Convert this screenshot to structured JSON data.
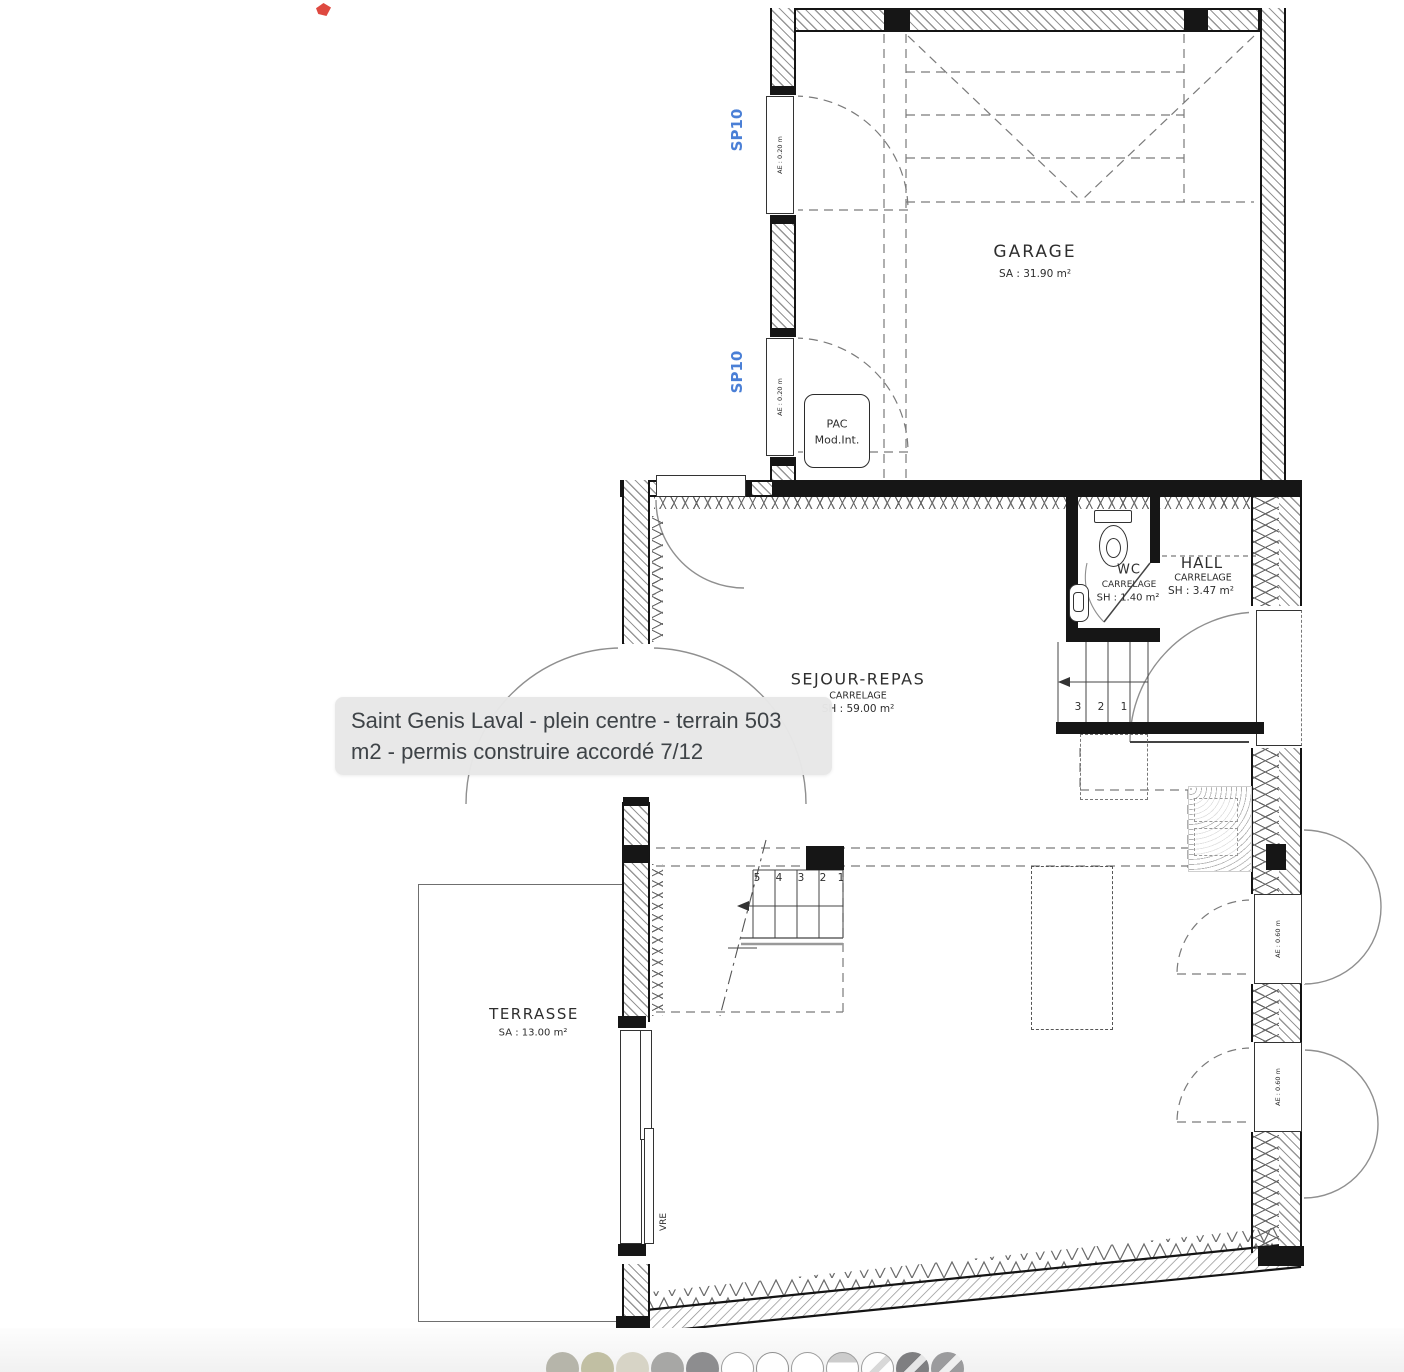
{
  "viewer": {
    "caption": {
      "line1": "Saint Genis Laval - plein centre - terrain 503",
      "line2": "m2 - permis construire accordé 7/12"
    },
    "thumbnails": [
      {
        "kind": "photo",
        "bg": "#b6b5aa"
      },
      {
        "kind": "photo",
        "bg": "#c1bfa3"
      },
      {
        "kind": "photo",
        "bg": "#d7d4c6"
      },
      {
        "kind": "photo",
        "bg": "#a7a7a5"
      },
      {
        "kind": "photo",
        "bg": "#8d8d8f"
      },
      {
        "kind": "plan",
        "bg": "#ffffff",
        "ring": "#9c9c9c"
      },
      {
        "kind": "plan",
        "bg": "#fefefe",
        "ring": "#8f8f8f"
      },
      {
        "kind": "plan",
        "bg": "#ffffff",
        "ring": "#9c9c9c"
      },
      {
        "kind": "plan",
        "bg": "#ffffff",
        "ring": "#9c9c9c",
        "band": "#cccccc"
      },
      {
        "kind": "plan",
        "bg": "#fdfdfd",
        "ring": "#9c9c9c",
        "stripe": "#d8d8d8"
      },
      {
        "kind": "photo",
        "bg": "#7f7f81",
        "stripe": "#e6e6e6"
      },
      {
        "kind": "photo",
        "bg": "#9b9b9d",
        "stripe": "#efefef"
      }
    ]
  },
  "plan": {
    "rooms": {
      "garage": {
        "name": "GARAGE",
        "area": "SA : 31.90 m²"
      },
      "sejour": {
        "name": "SEJOUR-REPAS",
        "floor": "CARRELAGE",
        "area": "SH : 59.00 m²"
      },
      "wc": {
        "name": "WC",
        "floor": "CARRELAGE",
        "area": "SH : 1.40 m²"
      },
      "hall": {
        "name": "HALL",
        "floor": "CARRELAGE",
        "area": "SH : 3.47 m²"
      },
      "terrasse": {
        "name": "TERRASSE",
        "area": "SA : 13.00 m²"
      }
    },
    "equipment": {
      "pac_line1": "PAC",
      "pac_line2": "Mod.Int."
    },
    "openings": {
      "sp10": "SP10",
      "ae_020": "AE : 0.20 m",
      "ae_060": "AE : 0.60 m",
      "vre": "VRE"
    },
    "stairs": {
      "main": [
        "5",
        "4",
        "3",
        "2",
        "1"
      ],
      "hall": [
        "3",
        "2",
        "1"
      ]
    },
    "colors": {
      "blue_label": "#4a7fd6",
      "wall": "#161616",
      "red_marker": "#db3a30",
      "tooltip_bg": "#e7e7e7"
    }
  }
}
